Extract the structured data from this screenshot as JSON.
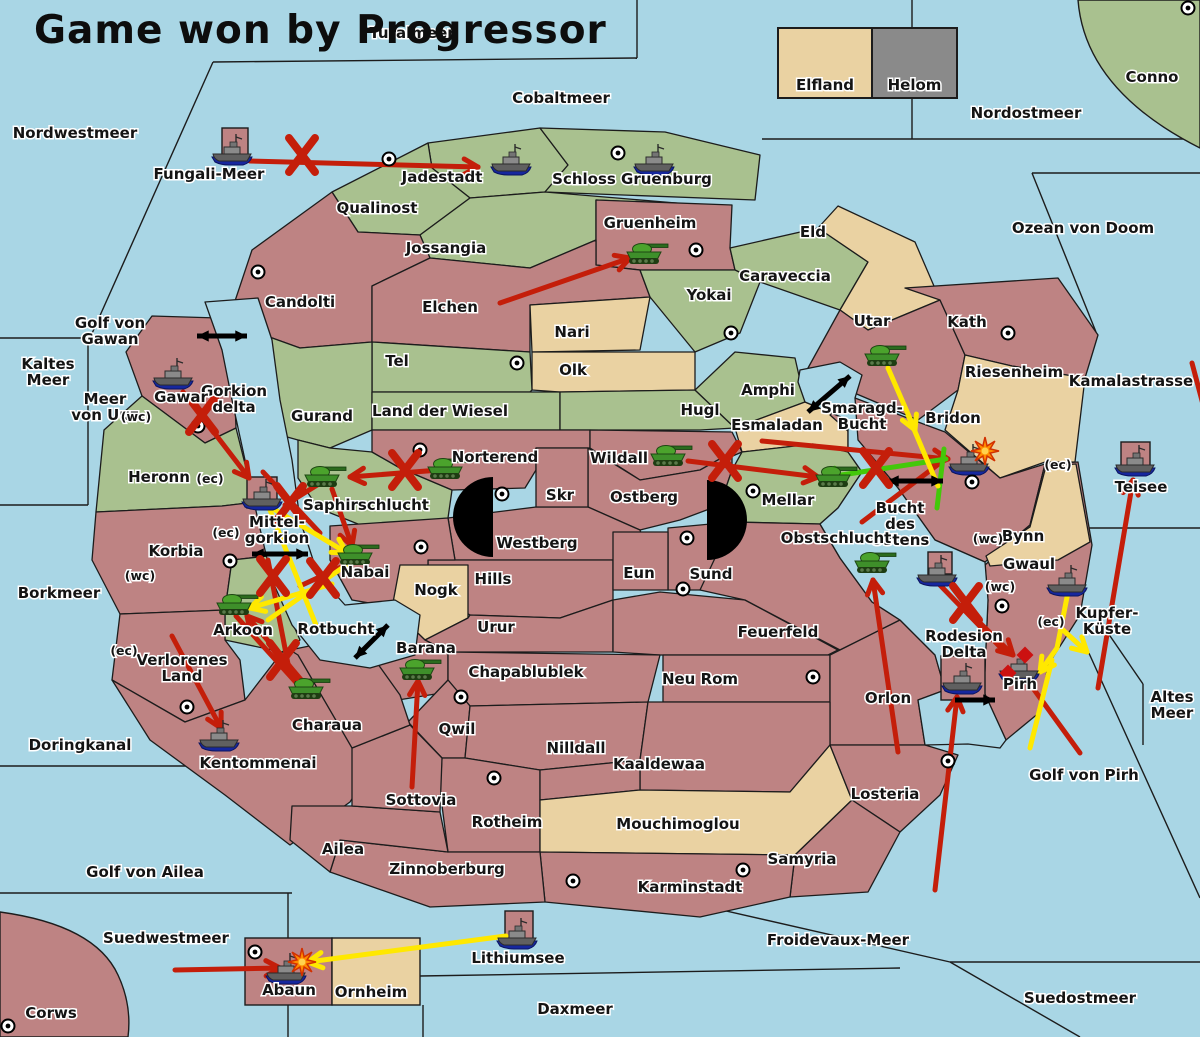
{
  "title": "Game won by Progressor",
  "legend": {
    "items": [
      {
        "label": "Elfland",
        "color_key": "tan"
      },
      {
        "label": "Helom",
        "color_key": "gray",
        "has_ship": true
      }
    ]
  },
  "colors": {
    "sea": "#A9D6E5",
    "pink": "#BE8383",
    "green": "#A9C18F",
    "tan": "#EAD2A2",
    "gray": "#8A8A8A",
    "red_arrow": "#C41E0A",
    "yellow_arrow": "#FFE800",
    "green_arrow": "#44C80A",
    "black": "#111111"
  },
  "labels": {
    "seas": [
      {
        "t": "Turalmeer",
        "x": 412,
        "y": 38
      },
      {
        "t": "Nordwestmeer",
        "x": 75,
        "y": 138
      },
      {
        "t": "Cobaltmeer",
        "x": 561,
        "y": 103
      },
      {
        "t": "Nordostmeer",
        "x": 1026,
        "y": 118
      },
      {
        "t": "Conno",
        "x": 1152,
        "y": 82
      },
      {
        "t": "Ozean von Doom",
        "x": 1083,
        "y": 233
      },
      {
        "t": "Kamalastrasse",
        "x": 1131,
        "y": 386
      },
      {
        "t": "Kaltes Meer",
        "l": [
          "Kaltes",
          "Meer"
        ],
        "x": 48,
        "y": 369
      },
      {
        "t": "Golf von Gawan",
        "l": [
          "Golf von",
          "Gawan"
        ],
        "x": 110,
        "y": 328
      },
      {
        "t": "Meer von Uuz",
        "l": [
          "Meer",
          "von Uuz"
        ],
        "x": 105,
        "y": 404
      },
      {
        "t": "Fungali-Meer",
        "x": 209,
        "y": 179
      },
      {
        "t": "Gorkion delta",
        "l": [
          "Gorkion",
          "delta"
        ],
        "x": 234,
        "y": 396
      },
      {
        "t": "Mittel-gorkion",
        "l": [
          "Mittel-",
          "gorkion"
        ],
        "x": 277,
        "y": 527
      },
      {
        "t": "Borkmeer",
        "x": 59,
        "y": 598
      },
      {
        "t": "Rotbucht",
        "x": 336,
        "y": 634
      },
      {
        "t": "Doringkanal",
        "x": 80,
        "y": 750
      },
      {
        "t": "Golf von Ailea",
        "x": 145,
        "y": 877
      },
      {
        "t": "Suedwestmeer",
        "x": 166,
        "y": 943
      },
      {
        "t": "Corws",
        "x": 51,
        "y": 1018
      },
      {
        "t": "Daxmeer",
        "x": 575,
        "y": 1014
      },
      {
        "t": "Froidevaux-Meer",
        "x": 838,
        "y": 945
      },
      {
        "t": "Suedostmeer",
        "x": 1080,
        "y": 1003
      },
      {
        "t": "Golf von Pirh",
        "x": 1084,
        "y": 780
      },
      {
        "t": "Altes Meer",
        "l": [
          "Altes",
          "Meer"
        ],
        "x": 1172,
        "y": 702
      },
      {
        "t": "Kupfer-Küste",
        "l": [
          "Kupfer-",
          "Küste"
        ],
        "x": 1107,
        "y": 618
      },
      {
        "t": "Teisee",
        "x": 1141,
        "y": 492
      },
      {
        "t": "Lithiumsee",
        "x": 518,
        "y": 963
      },
      {
        "t": "Smaragd-Bucht",
        "l": [
          "Smaragd-",
          "Bucht"
        ],
        "x": 862,
        "y": 413
      },
      {
        "t": "Bucht des Ostens",
        "l": [
          "Bucht",
          "des",
          "Ostens"
        ],
        "x": 900,
        "y": 513
      }
    ],
    "regions": [
      {
        "t": "Jadestadt",
        "x": 442,
        "y": 182
      },
      {
        "t": "Schloss Gruenburg",
        "x": 632,
        "y": 184
      },
      {
        "t": "Qualinost",
        "x": 377,
        "y": 213
      },
      {
        "t": "Jossangia",
        "x": 446,
        "y": 253
      },
      {
        "t": "Gruenheim",
        "x": 650,
        "y": 228
      },
      {
        "t": "Caraveccia",
        "x": 785,
        "y": 281
      },
      {
        "t": "Eld",
        "x": 813,
        "y": 237
      },
      {
        "t": "Candolti",
        "x": 300,
        "y": 307
      },
      {
        "t": "Elchen",
        "x": 450,
        "y": 312
      },
      {
        "t": "Yokai",
        "x": 709,
        "y": 300
      },
      {
        "t": "Nari",
        "x": 572,
        "y": 337
      },
      {
        "t": "Olk",
        "x": 573,
        "y": 375
      },
      {
        "t": "Tel",
        "x": 397,
        "y": 366
      },
      {
        "t": "Gurand",
        "x": 322,
        "y": 421
      },
      {
        "t": "Land der Wiesel",
        "x": 440,
        "y": 416
      },
      {
        "t": "Hugl",
        "x": 700,
        "y": 415
      },
      {
        "t": "Amphi",
        "x": 768,
        "y": 395
      },
      {
        "t": "Esmaladan",
        "x": 777,
        "y": 430
      },
      {
        "t": "Utar",
        "x": 872,
        "y": 326
      },
      {
        "t": "Kath",
        "x": 967,
        "y": 327
      },
      {
        "t": "Riesenheim",
        "x": 1014,
        "y": 377
      },
      {
        "t": "Bridon",
        "x": 953,
        "y": 423
      },
      {
        "t": "Gawar",
        "x": 181,
        "y": 402
      },
      {
        "t": "Heronn",
        "x": 159,
        "y": 482
      },
      {
        "t": "Korbia",
        "x": 176,
        "y": 556
      },
      {
        "t": "Saphirschlucht",
        "x": 366,
        "y": 510
      },
      {
        "t": "Norterend",
        "x": 495,
        "y": 462
      },
      {
        "t": "Wildall",
        "x": 619,
        "y": 463
      },
      {
        "t": "Skr",
        "x": 560,
        "y": 500
      },
      {
        "t": "Ostberg",
        "x": 644,
        "y": 502
      },
      {
        "t": "Westberg",
        "x": 537,
        "y": 548
      },
      {
        "t": "Mellar",
        "x": 788,
        "y": 505
      },
      {
        "t": "Hills",
        "x": 493,
        "y": 584
      },
      {
        "t": "Eun",
        "x": 639,
        "y": 578
      },
      {
        "t": "Sund",
        "x": 711,
        "y": 579
      },
      {
        "t": "Obstschlucht",
        "x": 836,
        "y": 543
      },
      {
        "t": "Nabai",
        "x": 365,
        "y": 577
      },
      {
        "t": "Nogk",
        "x": 436,
        "y": 595
      },
      {
        "t": "Urur",
        "x": 496,
        "y": 632
      },
      {
        "t": "Barana",
        "x": 426,
        "y": 653
      },
      {
        "t": "Feuerfeld",
        "x": 778,
        "y": 637
      },
      {
        "t": "Arkoon",
        "x": 243,
        "y": 635
      },
      {
        "t": "Verlorenes Land",
        "l": [
          "Verlorenes",
          "Land"
        ],
        "x": 182,
        "y": 665
      },
      {
        "t": "Charaua",
        "x": 327,
        "y": 730
      },
      {
        "t": "Kentommenai",
        "x": 258,
        "y": 768
      },
      {
        "t": "Chapablublek",
        "x": 526,
        "y": 677
      },
      {
        "t": "Neu Rom",
        "x": 700,
        "y": 684
      },
      {
        "t": "Qwil",
        "x": 457,
        "y": 734
      },
      {
        "t": "Nilldall",
        "x": 576,
        "y": 753
      },
      {
        "t": "Kaaldewaa",
        "x": 659,
        "y": 769
      },
      {
        "t": "Rotheim",
        "x": 507,
        "y": 827
      },
      {
        "t": "Mouchimoglou",
        "x": 678,
        "y": 829
      },
      {
        "t": "Sottovia",
        "x": 421,
        "y": 805
      },
      {
        "t": "Losteria",
        "x": 885,
        "y": 799
      },
      {
        "t": "Orlon",
        "x": 888,
        "y": 703
      },
      {
        "t": "Rodesion Delta",
        "l": [
          "Rodesion",
          "Delta"
        ],
        "x": 964,
        "y": 641
      },
      {
        "t": "Pirh",
        "x": 1020,
        "y": 689
      },
      {
        "t": "Bynn",
        "x": 1023,
        "y": 541
      },
      {
        "t": "Gwaul",
        "x": 1029,
        "y": 569
      },
      {
        "t": "Zinnoberburg",
        "x": 447,
        "y": 874
      },
      {
        "t": "Ailea",
        "x": 343,
        "y": 854
      },
      {
        "t": "Samyria",
        "x": 802,
        "y": 864
      },
      {
        "t": "Karminstadt",
        "x": 690,
        "y": 892
      },
      {
        "t": "Abaun",
        "x": 289,
        "y": 995
      },
      {
        "t": "Ornheim",
        "x": 371,
        "y": 997
      }
    ],
    "modifiers": [
      {
        "t": "(wc)",
        "x": 136,
        "y": 421
      },
      {
        "t": "(ec)",
        "x": 210,
        "y": 483
      },
      {
        "t": "(ec)",
        "x": 226,
        "y": 537
      },
      {
        "t": "(wc)",
        "x": 140,
        "y": 580
      },
      {
        "t": "(ec)",
        "x": 124,
        "y": 655
      },
      {
        "t": "(ec)",
        "x": 1058,
        "y": 469
      },
      {
        "t": "(wc)",
        "x": 988,
        "y": 543
      },
      {
        "t": "(wc)",
        "x": 1000,
        "y": 591
      },
      {
        "t": "(ec)",
        "x": 1051,
        "y": 626
      }
    ]
  },
  "units": {
    "tanks": [
      [
        644,
        254
      ],
      [
        882,
        356
      ],
      [
        445,
        469
      ],
      [
        322,
        477
      ],
      [
        668,
        456
      ],
      [
        833,
        477
      ],
      [
        355,
        555
      ],
      [
        234,
        605
      ],
      [
        306,
        689
      ],
      [
        417,
        670
      ],
      [
        872,
        563
      ]
    ],
    "ships": [
      [
        233,
        150
      ],
      [
        512,
        160
      ],
      [
        655,
        160
      ],
      [
        908,
        57
      ],
      [
        174,
        374
      ],
      [
        263,
        495
      ],
      [
        970,
        460
      ],
      [
        938,
        571
      ],
      [
        1068,
        581
      ],
      [
        1136,
        461
      ],
      [
        1020,
        667
      ],
      [
        220,
        736
      ],
      [
        963,
        679
      ],
      [
        287,
        969
      ],
      [
        518,
        934
      ]
    ]
  },
  "markers": {
    "city_dots": [
      [
        389,
        159
      ],
      [
        618,
        153
      ],
      [
        696,
        250
      ],
      [
        731,
        333
      ],
      [
        258,
        272
      ],
      [
        517,
        363
      ],
      [
        1188,
        8
      ],
      [
        943,
        41
      ],
      [
        1008,
        333
      ],
      [
        198,
        426
      ],
      [
        230,
        561
      ],
      [
        420,
        450
      ],
      [
        502,
        494
      ],
      [
        421,
        547
      ],
      [
        687,
        538
      ],
      [
        753,
        491
      ],
      [
        683,
        589
      ],
      [
        972,
        482
      ],
      [
        1002,
        606
      ],
      [
        461,
        697
      ],
      [
        494,
        778
      ],
      [
        813,
        677
      ],
      [
        573,
        881
      ],
      [
        743,
        870
      ],
      [
        187,
        707
      ],
      [
        948,
        761
      ],
      [
        8,
        1026
      ],
      [
        255,
        952
      ]
    ],
    "x_marks": [
      [
        302,
        155
      ],
      [
        202,
        415
      ],
      [
        405,
        470
      ],
      [
        290,
        503
      ],
      [
        725,
        461
      ],
      [
        876,
        468
      ],
      [
        273,
        576
      ],
      [
        323,
        578
      ],
      [
        283,
        660
      ],
      [
        966,
        603
      ]
    ],
    "explosions": [
      [
        985,
        451
      ],
      [
        302,
        962
      ]
    ],
    "damage_diamonds": [
      [
        1025,
        655
      ],
      [
        1008,
        673
      ]
    ],
    "ferry_links": [
      {
        "x1": 197,
        "y1": 336,
        "x2": 247,
        "y2": 336
      },
      {
        "x1": 808,
        "y1": 412,
        "x2": 850,
        "y2": 376
      },
      {
        "x1": 887,
        "y1": 481,
        "x2": 943,
        "y2": 481
      },
      {
        "x1": 252,
        "y1": 554,
        "x2": 308,
        "y2": 554
      },
      {
        "x1": 355,
        "y1": 658,
        "x2": 388,
        "y2": 625
      }
    ],
    "black_arrows": [
      {
        "x1": 955,
        "y1": 700,
        "x2": 995,
        "y2": 700
      }
    ]
  },
  "moves": {
    "red": [
      [
        250,
        161,
        478,
        167,
        1
      ],
      [
        500,
        303,
        630,
        258,
        1
      ],
      [
        183,
        392,
        249,
        478,
        1
      ],
      [
        332,
        489,
        352,
        546,
        1
      ],
      [
        452,
        469,
        350,
        477,
        1
      ],
      [
        322,
        482,
        285,
        505,
        0
      ],
      [
        688,
        461,
        818,
        477,
        1
      ],
      [
        762,
        441,
        948,
        459,
        1
      ],
      [
        862,
        522,
        940,
        463,
        0
      ],
      [
        898,
        752,
        873,
        580,
        1
      ],
      [
        935,
        890,
        957,
        697,
        1
      ],
      [
        936,
        581,
        1003,
        650,
        0
      ],
      [
        977,
        620,
        1013,
        655,
        1
      ],
      [
        1030,
        684,
        1080,
        753,
        0
      ],
      [
        1098,
        688,
        1133,
        480,
        1
      ],
      [
        1192,
        363,
        1205,
        412,
        0
      ],
      [
        172,
        636,
        221,
        728,
        1
      ],
      [
        309,
        689,
        247,
        616,
        1
      ],
      [
        236,
        616,
        300,
        687,
        0
      ],
      [
        412,
        787,
        418,
        681,
        1
      ],
      [
        268,
        560,
        288,
        664,
        0
      ],
      [
        175,
        970,
        280,
        968,
        1
      ],
      [
        352,
        562,
        300,
        586,
        0
      ],
      [
        263,
        472,
        320,
        533,
        0
      ]
    ],
    "yellow": [
      [
        888,
        368,
        915,
        430,
        1
      ],
      [
        908,
        415,
        938,
        486,
        0
      ],
      [
        1068,
        592,
        1057,
        648,
        0
      ],
      [
        1057,
        648,
        1040,
        672,
        1
      ],
      [
        1063,
        630,
        1087,
        652,
        1
      ],
      [
        1052,
        660,
        1030,
        748,
        0
      ],
      [
        272,
        508,
        347,
        553,
        1
      ],
      [
        332,
        584,
        250,
        608,
        1
      ],
      [
        270,
        510,
        318,
        630,
        0
      ],
      [
        352,
        561,
        268,
        620,
        0
      ],
      [
        506,
        936,
        308,
        962,
        1
      ]
    ],
    "green": [
      [
        946,
        459,
        822,
        478,
        1
      ],
      [
        944,
        449,
        937,
        508,
        0
      ]
    ]
  }
}
